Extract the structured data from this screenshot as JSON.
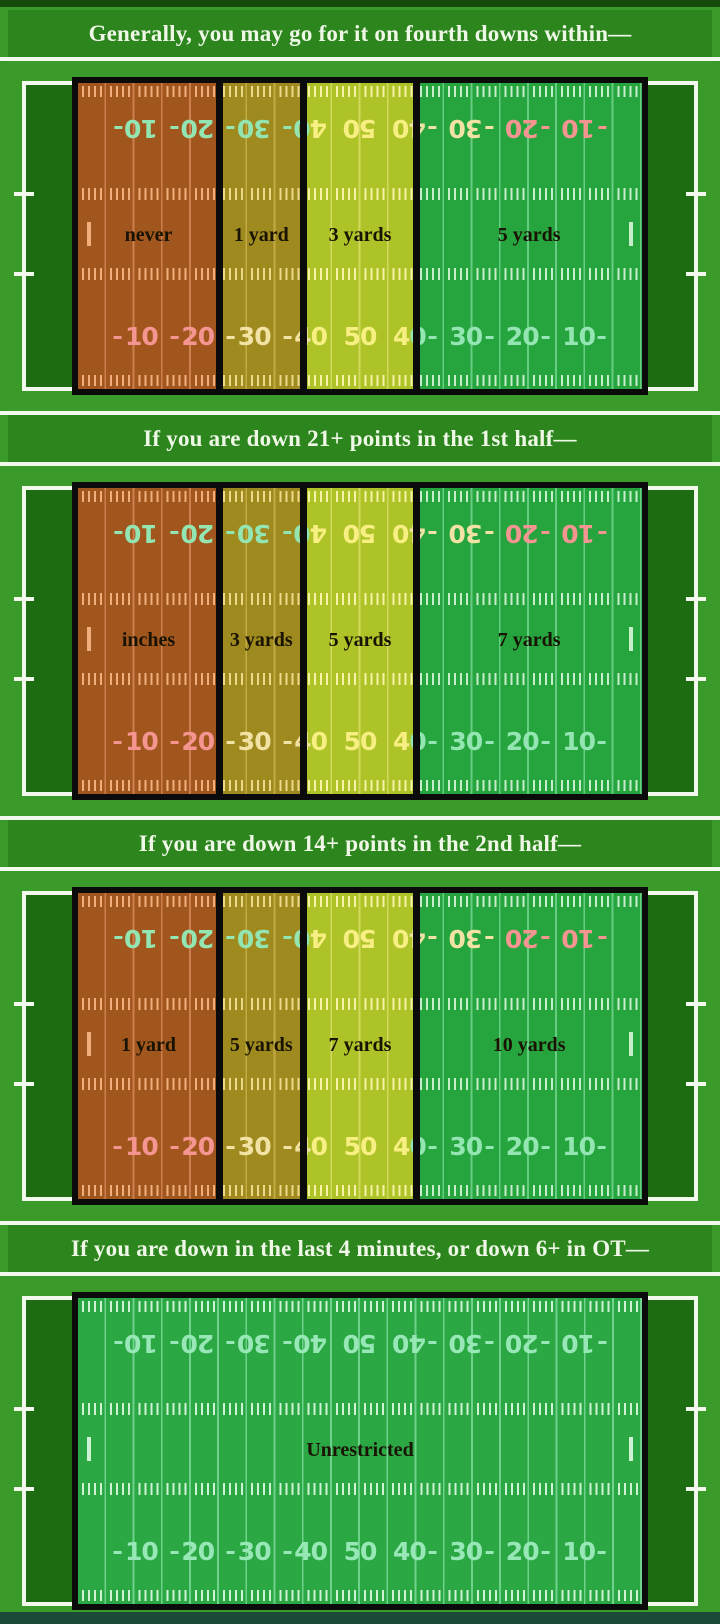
{
  "yard_numbers": [
    "10",
    "20",
    "30",
    "40",
    "50",
    "40",
    "30",
    "20",
    "10"
  ],
  "sections": [
    {
      "header": "Generally, you may go for it on fourth downs within—",
      "zones": [
        {
          "label": "never",
          "palette": "danger",
          "from_yard": 0,
          "to_yard": 25
        },
        {
          "label": "1 yard",
          "palette": "caution",
          "from_yard": 25,
          "to_yard": 40
        },
        {
          "label": "3 yards",
          "palette": "ready",
          "from_yard": 40,
          "to_yard": 60
        },
        {
          "label": "5 yards",
          "palette": "safe",
          "from_yard": 60,
          "to_yard": 100
        }
      ]
    },
    {
      "header": "If you are down 21+ points in the 1st half—",
      "zones": [
        {
          "label": "inches",
          "palette": "danger",
          "from_yard": 0,
          "to_yard": 25
        },
        {
          "label": "3 yards",
          "palette": "caution",
          "from_yard": 25,
          "to_yard": 40
        },
        {
          "label": "5 yards",
          "palette": "ready",
          "from_yard": 40,
          "to_yard": 60
        },
        {
          "label": "7 yards",
          "palette": "safe",
          "from_yard": 60,
          "to_yard": 100
        }
      ]
    },
    {
      "header": "If you are down 14+ points in the 2nd half—",
      "zones": [
        {
          "label": "1 yard",
          "palette": "danger",
          "from_yard": 0,
          "to_yard": 25
        },
        {
          "label": "5 yards",
          "palette": "caution",
          "from_yard": 25,
          "to_yard": 40
        },
        {
          "label": "7 yards",
          "palette": "ready",
          "from_yard": 40,
          "to_yard": 60
        },
        {
          "label": "10 yards",
          "palette": "safe",
          "from_yard": 60,
          "to_yard": 100
        }
      ]
    },
    {
      "header": "If you are down in the last 4 minutes, or down 6+ in OT—",
      "zones": [
        {
          "label": "Unrestricted",
          "palette": "open",
          "from_yard": 0,
          "to_yard": 100
        }
      ]
    }
  ],
  "colors": {
    "page_bg": "#3b9b2a",
    "header_bar": "#2c851d",
    "header_text": "#eff8e7",
    "separator": "#f3f9ec",
    "sideline": "#f3f9ec",
    "field_dark": "#1d6c12",
    "border_black": "#0b0b0b",
    "edge_top": "#174b0e",
    "edge_bottom": "#1c4a38",
    "label_text": "#191303"
  },
  "palettes": {
    "danger": {
      "bg": "#a1561e",
      "line": "#cd7f4e",
      "tick": "#efae7c",
      "num": "#f59592"
    },
    "caution": {
      "bg": "#9f8a1f",
      "line": "#c3ab43",
      "tick": "#ecd98a",
      "num": "#f2e2a4"
    },
    "ready": {
      "bg": "#aec327",
      "line": "#d2d95e",
      "tick": "#f7f2a6",
      "num": "#f7ef82"
    },
    "safe": {
      "bg": "#26a43e",
      "line": "#67cd83",
      "tick": "#c6eecb",
      "num": "#93e5b1"
    },
    "open": {
      "bg": "#2ba744",
      "line": "#6fd28d",
      "tick": "#cdf2d4",
      "num": "#97e8b6"
    }
  }
}
